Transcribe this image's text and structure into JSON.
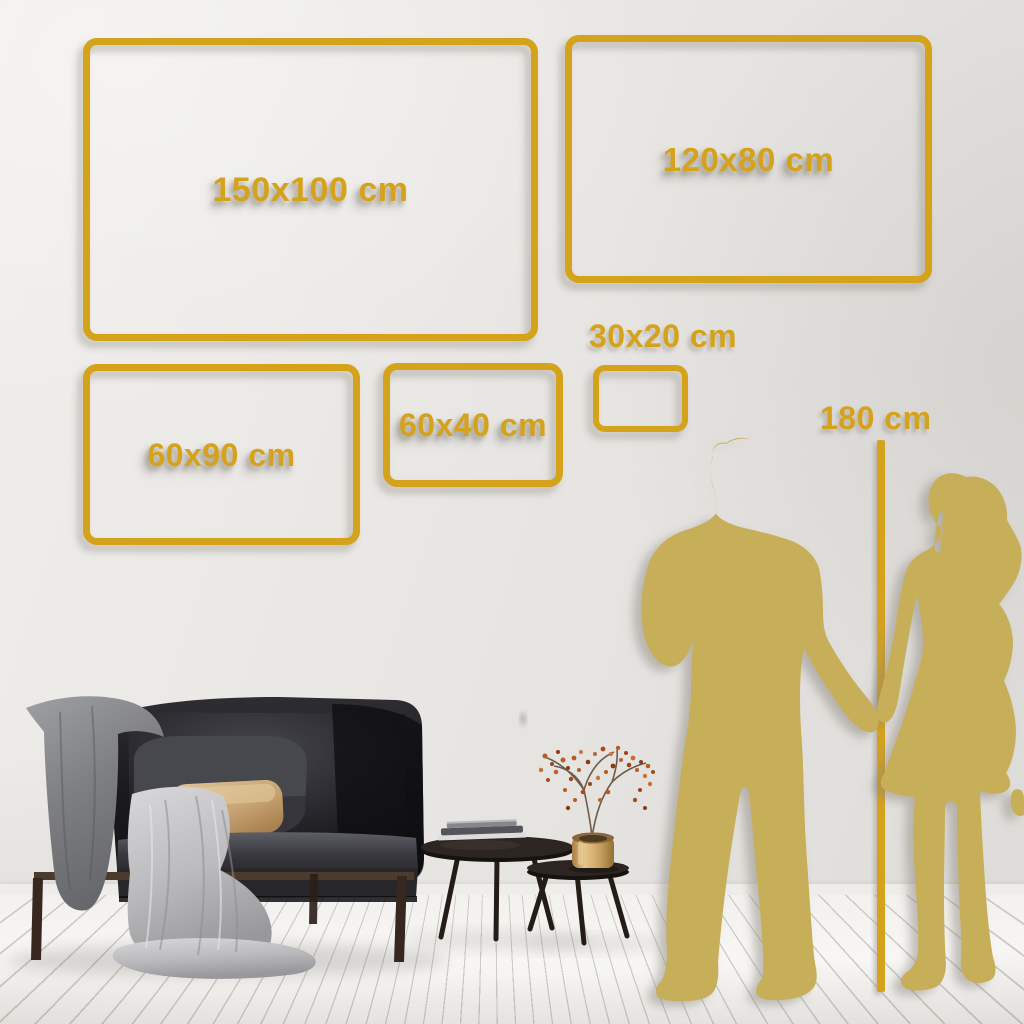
{
  "size_guide": {
    "unit": "cm",
    "frames": [
      {
        "id": "150x100",
        "label": "150x100 cm",
        "width_cm": 150,
        "height_cm": 100
      },
      {
        "id": "120x80",
        "label": "120x80 cm",
        "width_cm": 120,
        "height_cm": 80
      },
      {
        "id": "60x90",
        "label": "60x90 cm",
        "width_cm": 60,
        "height_cm": 90
      },
      {
        "id": "60x40",
        "label": "60x40 cm",
        "width_cm": 60,
        "height_cm": 40
      },
      {
        "id": "30x20",
        "label": "30x20 cm",
        "width_cm": 30,
        "height_cm": 20
      }
    ],
    "height_reference": {
      "label": "180 cm",
      "value_cm": 180
    },
    "colors": {
      "accent_gold": "#D5A21C",
      "silhouette_gold": "#C7AE58",
      "wall": "#E8E6E3",
      "floor": "#F5F4F2"
    }
  }
}
